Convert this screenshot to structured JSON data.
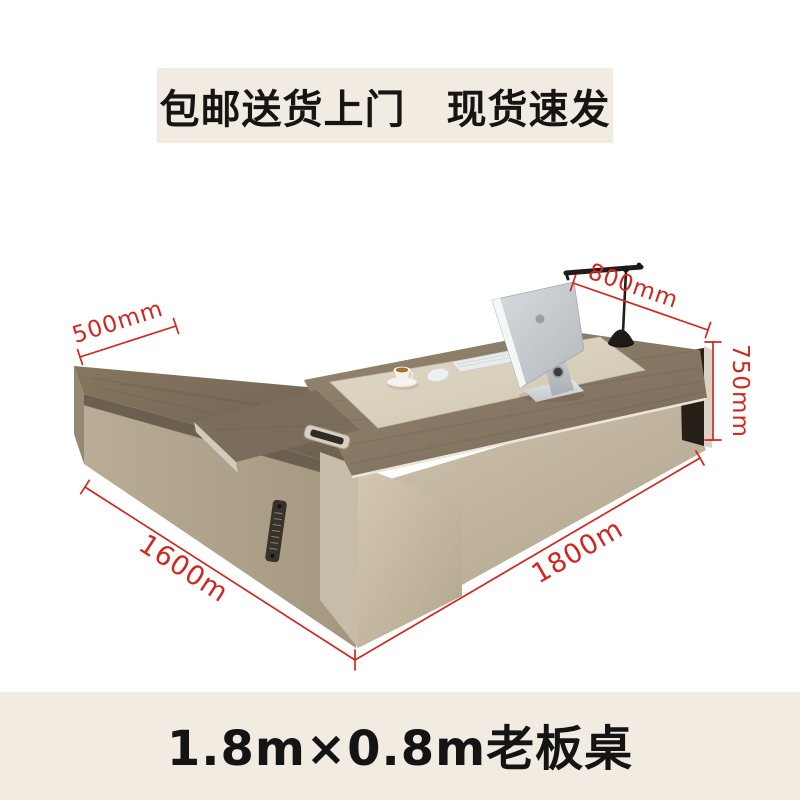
{
  "banner": {
    "text": "包邮送货上门　现货速发"
  },
  "caption": {
    "text": "1.8m×0.8m老板桌"
  },
  "dimensions": {
    "return_depth": {
      "label": "500mm"
    },
    "desk_depth": {
      "label": "800mm"
    },
    "desk_height": {
      "label": "750mm"
    },
    "return_length": {
      "label": "1600m"
    },
    "desk_length": {
      "label": "1800m"
    }
  },
  "colors": {
    "dimension_red": "#d2261f",
    "band_background": "#f1ebe1",
    "text_color": "#141414",
    "desk_wood": "#8a7b69",
    "desk_inlay_cream": "#d8d0bd",
    "desk_greige": "#b3a791",
    "end_panel_dark": "#262019"
  },
  "scene": {
    "objects": [
      "l-shaped-executive-desk",
      "desk-lamp",
      "imac-computer",
      "keyboard",
      "mouse",
      "coffee-cup",
      "cable-grommet",
      "vent-grille"
    ]
  }
}
